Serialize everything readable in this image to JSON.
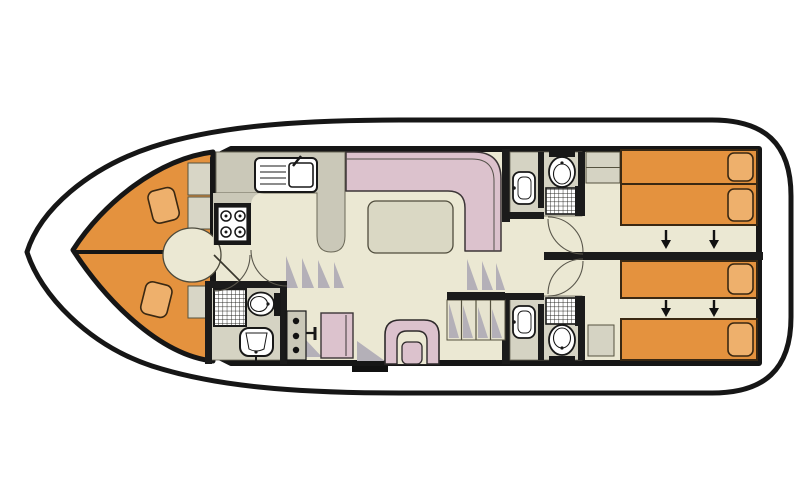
{
  "diagram": {
    "type": "houseboat-deck-floor-plan",
    "orientation": "bow-left-stern-right",
    "berth_count": 6,
    "bathroom_count": 3
  },
  "colors": {
    "background": "#ffffff",
    "hull_fill": "#ffffff",
    "outline": "#1b1b1b",
    "floor": "#ebe8d3",
    "zone_grey": "#d5d3c3",
    "counter": "#cac8b8",
    "cabinet": "#d8d6c6",
    "bed": "#e4923e",
    "pillow": "#eeb06c",
    "bed_outline": "#3a2812",
    "seat_pink": "#dcc2cd",
    "table": "#dad8c4",
    "shade": "#b4b0b8",
    "fixture_white": "#ffffff",
    "tread": "#e6e3cf"
  },
  "areas": {
    "bow_cabin": {
      "name": "bow-v-berth-cabin",
      "berths": 2,
      "features": [
        "two-tapered-berths",
        "two-pillows",
        "center-divider",
        "rounded-entry-landing",
        "side-cabinets"
      ]
    },
    "galley": {
      "name": "galley",
      "features": [
        "sink-with-drainer",
        "faucet",
        "four-burner-stove",
        "counter-peninsula"
      ]
    },
    "saloon": {
      "name": "saloon",
      "features": [
        "l-shaped-bench-seat",
        "dining-table"
      ]
    },
    "helm": {
      "name": "helm-station",
      "features": [
        "instrument-console-three-gauges",
        "throttle-lever",
        "helm-seat",
        "u-shaped-armchair",
        "boarding-step"
      ]
    },
    "forward_bathroom": {
      "name": "forward-bathroom",
      "features": [
        "shower",
        "toilet",
        "washbasin"
      ]
    },
    "stairs": {
      "name": "companionway-stairs",
      "steps": 4
    },
    "aft_cabin_upper": {
      "name": "aft-cabin-port",
      "berths": 2,
      "features": [
        "two-single-beds-joined",
        "slide-arrows",
        "cabinet"
      ]
    },
    "aft_cabin_lower": {
      "name": "aft-cabin-starboard",
      "berths": 2,
      "features": [
        "two-single-beds-separated",
        "slide-arrows",
        "cabinet"
      ]
    },
    "aft_bathroom_upper": {
      "name": "ensuite-bathroom-port",
      "features": [
        "washbasin",
        "toilet",
        "shower"
      ]
    },
    "aft_bathroom_lower": {
      "name": "ensuite-bathroom-starboard",
      "features": [
        "washbasin",
        "toilet",
        "shower"
      ]
    }
  }
}
